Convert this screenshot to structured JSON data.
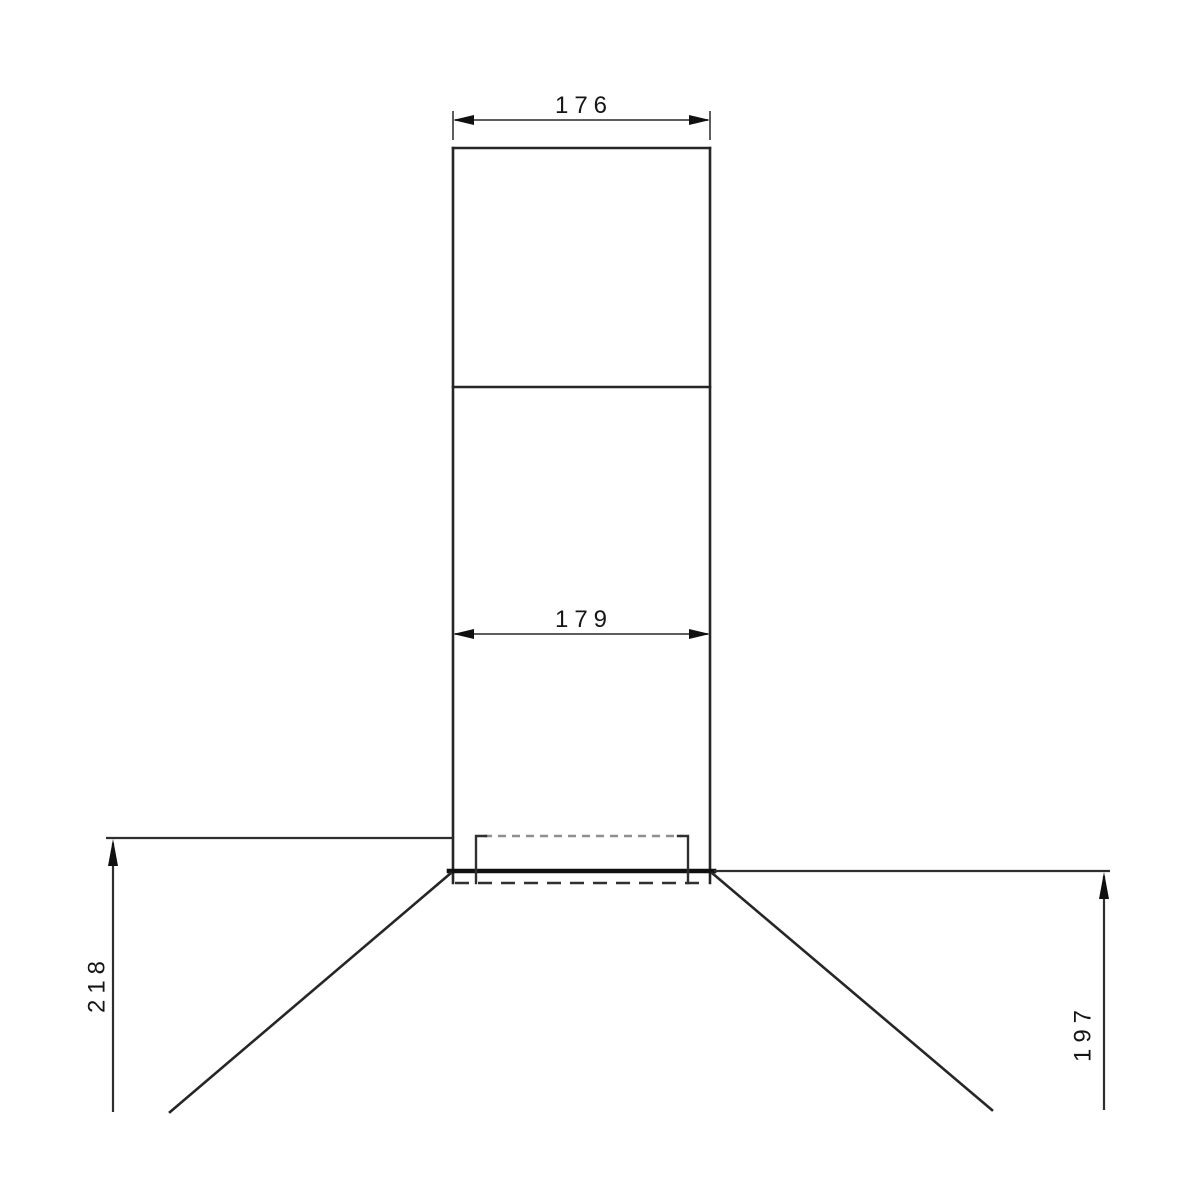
{
  "drawing": {
    "type": "technical-dimension-drawing",
    "subject": "chimney-range-hood-front-elevation",
    "labels": {
      "top_width": "176",
      "inner_width": "179",
      "left_height": "218",
      "right_height": "197"
    },
    "colors": {
      "background": "#ffffff",
      "body_line": "#262626",
      "thick_edge": "#101010",
      "dimension_line": "#5e5e5e",
      "arrow_and_text": "#161616",
      "hidden_line_light": "#8f8f8f",
      "hidden_line_dark": "#303030"
    }
  }
}
